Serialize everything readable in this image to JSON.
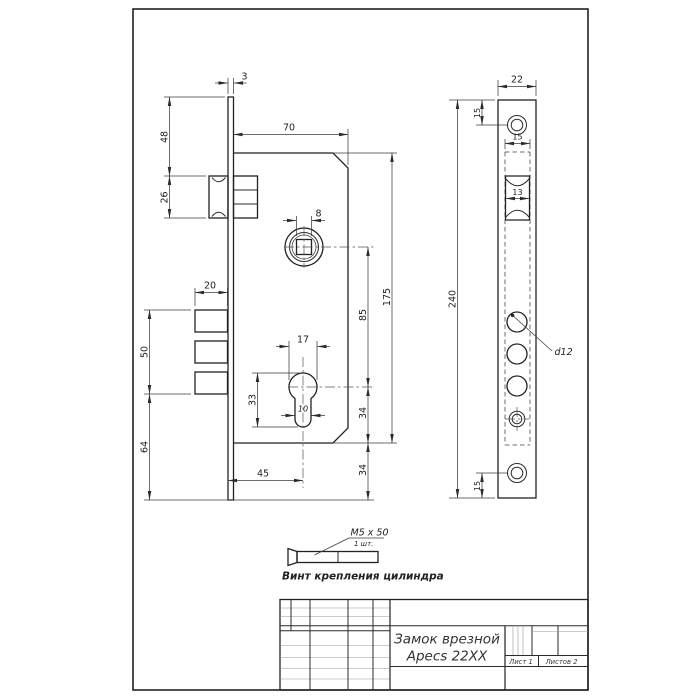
{
  "main_view": {
    "dims": {
      "plate_thickness": "3",
      "top_to_latch": "48",
      "latch_height": "26",
      "body_width": "70",
      "square": "8",
      "bolt_width": "20",
      "bolts_span": "50",
      "bottom_span": "64",
      "cyl_width": "17",
      "cyl_height": "33",
      "cyl_stem": "10",
      "backset": "45",
      "axis_distance": "85",
      "cyl_to_body": "34",
      "body_to_plate": "34",
      "body_height": "175"
    }
  },
  "face_view": {
    "dims": {
      "width": "22",
      "top_screw": "15",
      "slot_width": "15",
      "latch_width": "13",
      "height": "240",
      "bottom_screw": "15"
    },
    "bolt_label": "d12"
  },
  "screw_note": {
    "size": "M5 x 50",
    "qty": "1 шт.",
    "caption": "Винт крепления цилиндра"
  },
  "title_block": {
    "name_line1": "Замок врезной",
    "name_line2": "Apecs 22XX",
    "sheet": "Лист 1",
    "sheets": "Листов 2"
  },
  "colors": {
    "ink": "#2b2b2b",
    "paper": "#ffffff",
    "light_grid": "#9a9a9a"
  }
}
